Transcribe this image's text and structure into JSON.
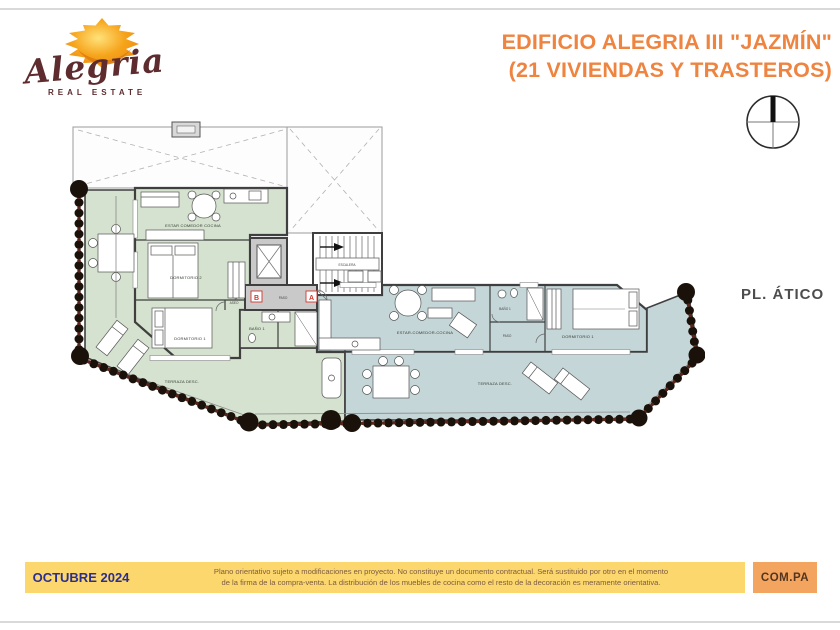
{
  "brand": {
    "name": "Alegria",
    "tagline": "REAL ESTATE"
  },
  "header": {
    "title_line1": "EDIFICIO ALEGRIA III \"JAZMÍN\"",
    "title_line2": "(21 VIVIENDAS Y TRASTEROS)"
  },
  "plan": {
    "floor_label": "PL. ÁTICO",
    "core": {
      "stairs": "ESCALERA",
      "hall": "PASO",
      "unit_a_marker": "A",
      "unit_b_marker": "B"
    },
    "unit_b": {
      "living": "ESTAR COMEDOR COCINA",
      "bedroom2": "DORMITORIO 2",
      "bedroom1": "DORMITORIO 1",
      "bath": "BAÑO 1",
      "toilet": "ASEO",
      "terrace": "TERRAZA DESC."
    },
    "unit_a": {
      "living": "ESTAR-COMEDOR-COCINA",
      "hall": "PASO",
      "bath": "BAÑO 1",
      "bedroom1": "DORMITORIO 1",
      "terrace": "TERRAZA DESC."
    }
  },
  "footer": {
    "date": "OCTUBRE 2024",
    "disclaimer_line1": "Plano orientativo sujeto a modificaciones en proyecto. No constituye un documento contractual. Será sustituido por otro en el momento",
    "disclaimer_line2": "de la firma de la compra-venta. La distribución de los muebles de cocina como el resto de la decoración es meramente orientativa.",
    "code": "COM.PA"
  },
  "colors": {
    "accent_orange": "#EE8440",
    "unit_b_fill": "#d5e2cf",
    "unit_a_fill": "#c5d6d8",
    "core_fill": "#c9c9c9",
    "hedge_dark": "#1a120a",
    "hedge_red": "#5a251a",
    "footer_yellow": "#FCD76D",
    "footer_code_bg": "#F3A55F",
    "date_navy": "#2B2F8E",
    "logo_maroon": "#5E2C2F"
  }
}
